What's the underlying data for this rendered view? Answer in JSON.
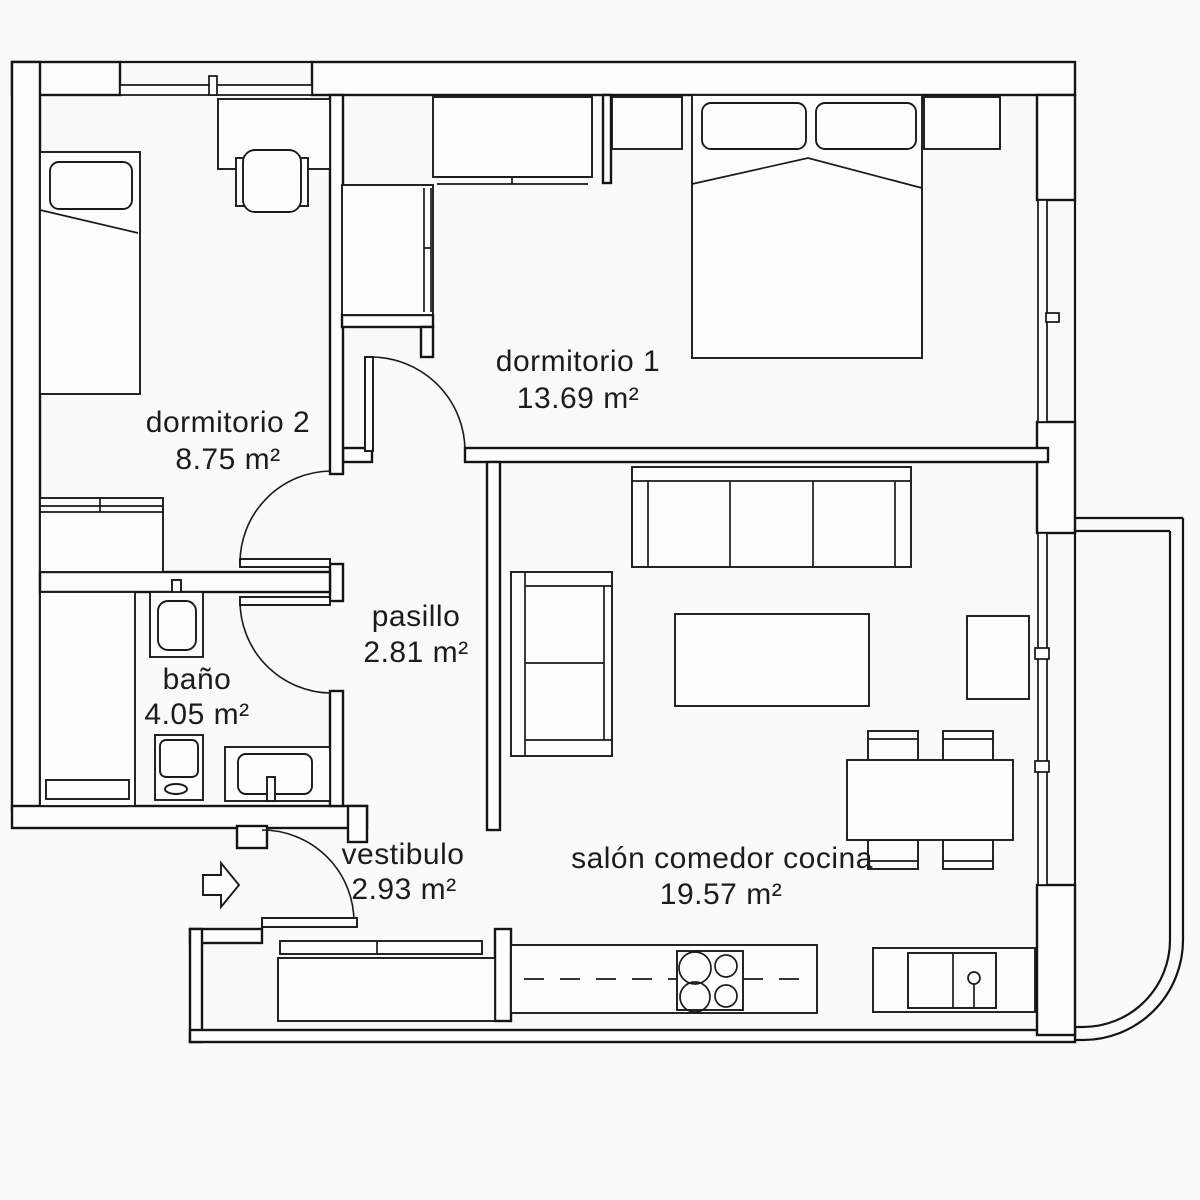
{
  "plan": {
    "type": "apartment-floor-plan",
    "background_color": "#fafafa",
    "line_color": "#141414",
    "rooms": [
      {
        "name": "dormitorio 2",
        "area": "8.75 m²"
      },
      {
        "name": "dormitorio 1",
        "area": "13.69 m²"
      },
      {
        "name": "pasillo",
        "area": "2.81 m²"
      },
      {
        "name": "baño",
        "area": "4.05 m²"
      },
      {
        "name": "vestibulo",
        "area": "2.93 m²"
      },
      {
        "name": "salón comedor cocina",
        "area": "19.57 m²"
      }
    ],
    "entry": {
      "icon": "entry-arrow-icon",
      "direction": "right"
    }
  }
}
